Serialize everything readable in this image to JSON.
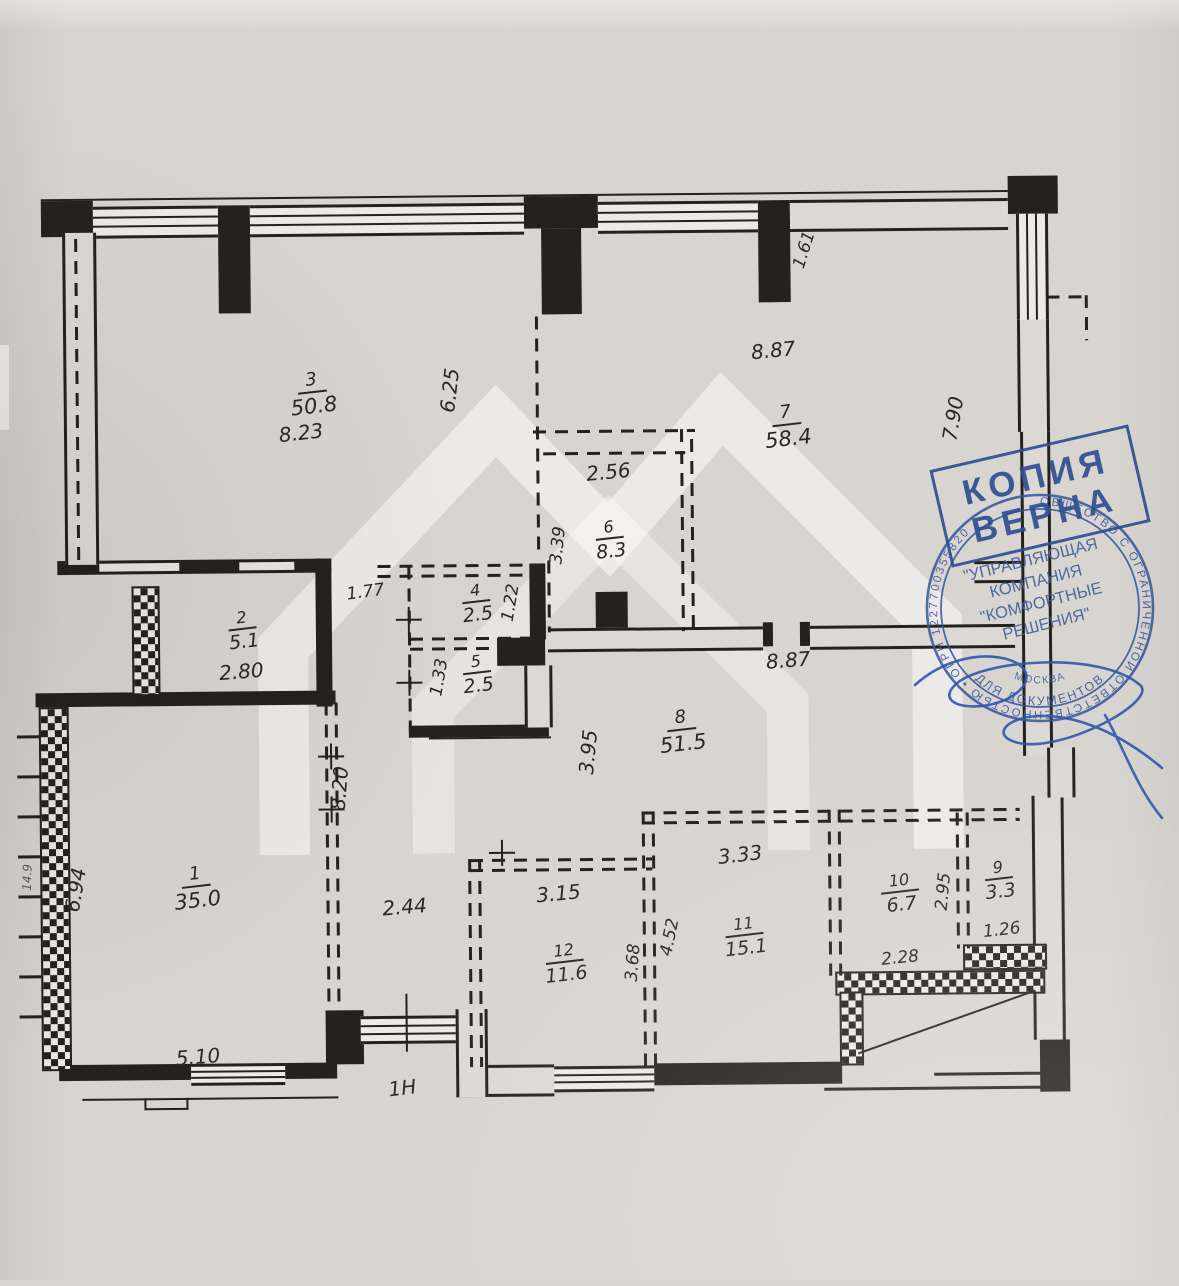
{
  "colors": {
    "paper": "#d8d5d0",
    "ink": "#24221d",
    "stamp_blue": "#2e4f92"
  },
  "rooms": [
    {
      "number": "1",
      "area": "35.0"
    },
    {
      "number": "2",
      "area": "5.1"
    },
    {
      "number": "3",
      "area": "50.8"
    },
    {
      "number": "4",
      "area": "2.5"
    },
    {
      "number": "5",
      "area": "2.5"
    },
    {
      "number": "6",
      "area": "8.3"
    },
    {
      "number": "7",
      "area": "58.4"
    },
    {
      "number": "8",
      "area": "51.5"
    },
    {
      "number": "9",
      "area": "3.3"
    },
    {
      "number": "10",
      "area": "6.7"
    },
    {
      "number": "11",
      "area": "15.1"
    },
    {
      "number": "12",
      "area": "11.6"
    }
  ],
  "dims": [
    {
      "text": "8.23"
    },
    {
      "text": "6.25"
    },
    {
      "text": "1.61"
    },
    {
      "text": "8.87"
    },
    {
      "text": "7.90"
    },
    {
      "text": "2.56"
    },
    {
      "text": "3.39"
    },
    {
      "text": "1.77"
    },
    {
      "text": "2.80"
    },
    {
      "text": "1.22"
    },
    {
      "text": "1.33"
    },
    {
      "text": "8.87"
    },
    {
      "text": "3.95"
    },
    {
      "text": "8.20"
    },
    {
      "text": "6.94"
    },
    {
      "text": "2.44"
    },
    {
      "text": "5.10"
    },
    {
      "text": "3.15"
    },
    {
      "text": "3.68"
    },
    {
      "text": "4.52"
    },
    {
      "text": "3.33"
    },
    {
      "text": "2.95"
    },
    {
      "text": "1.26"
    },
    {
      "text": "2.28"
    },
    {
      "text": "14.9"
    }
  ],
  "labels": {
    "entrance_unit": "1Н"
  },
  "stamp": {
    "copy_line1": "КОПИЯ",
    "copy_line2": "ВЕРНА",
    "ring_text": "ОБЩЕСТВО С ОГРАНИЧЕННОЙ ОТВЕТСТВЕННОСТЬЮ  •  ОГРН 1227700355820",
    "center_line1": "\"УПРАВЛЯЮЩАЯ",
    "center_line2": "КОМПАНИЯ",
    "center_line3": "\"КОМФОРТНЫЕ",
    "center_line4": "РЕШЕНИЯ\"",
    "inner_bottom": "ДЛЯ ДОКУМЕНТОВ",
    "city": "МОСКВА"
  }
}
